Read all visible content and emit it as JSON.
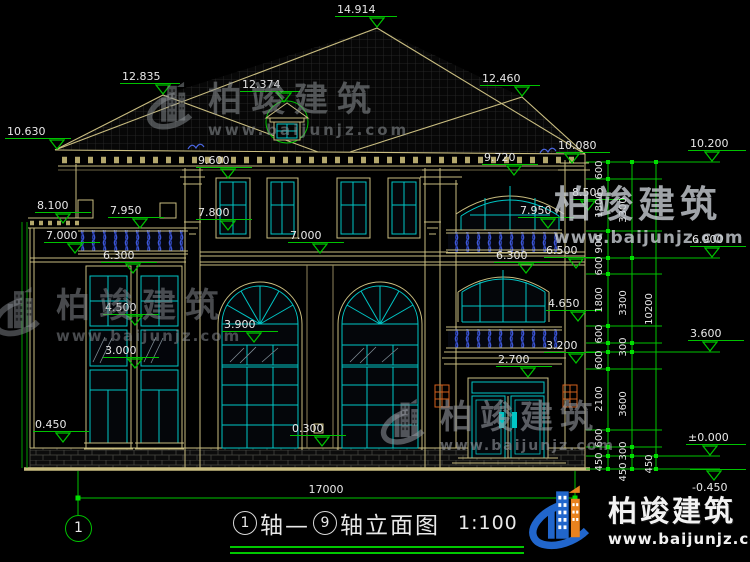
{
  "brand": {
    "name": "柏竣建筑",
    "url": "www.baijunjz.com"
  },
  "title": {
    "axis_start": "1",
    "mid": "轴—",
    "axis_end": "9",
    "suffix": "轴立面图",
    "scale": "1:100"
  },
  "axis_bubble_label": "1",
  "total_width_dim": "17000",
  "elevation_markers": [
    {
      "label": "14.914",
      "tip": [
        377,
        28
      ],
      "lx": 335,
      "lw": 62
    },
    {
      "label": "12.835",
      "tip": [
        163,
        95
      ],
      "lx": 120,
      "lw": 60
    },
    {
      "label": "12.374",
      "tip": [
        284,
        103
      ],
      "lx": 240,
      "lw": 60
    },
    {
      "label": "12.460",
      "tip": [
        522,
        97
      ],
      "lx": 480,
      "lw": 60
    },
    {
      "label": "10.630",
      "tip": [
        57,
        150
      ],
      "lx": 5,
      "lw": 66
    },
    {
      "label": "10.080",
      "tip": [
        572,
        164
      ],
      "lx": 556,
      "lw": 54
    },
    {
      "label": "9.600",
      "tip": [
        228,
        179
      ],
      "lx": 196,
      "lw": 56
    },
    {
      "label": "9.720",
      "tip": [
        514,
        176
      ],
      "lx": 482,
      "lw": 56
    },
    {
      "label": "8.100",
      "tip": [
        63,
        224
      ],
      "lx": 35,
      "lw": 56
    },
    {
      "label": "7.950",
      "tip": [
        140,
        229
      ],
      "lx": 108,
      "lw": 56
    },
    {
      "label": "7.800",
      "tip": [
        228,
        231
      ],
      "lx": 196,
      "lw": 56
    },
    {
      "label": "8.500",
      "tip": [
        588,
        211
      ],
      "lx": 570,
      "lw": 54
    },
    {
      "label": "7.950",
      "tip": [
        548,
        229
      ],
      "lx": 518,
      "lw": 56
    },
    {
      "label": "7.000",
      "tip": [
        75,
        254
      ],
      "lx": 44,
      "lw": 56
    },
    {
      "label": "7.000",
      "tip": [
        320,
        254
      ],
      "lx": 288,
      "lw": 56
    },
    {
      "label": "6.300",
      "tip": [
        133,
        274
      ],
      "lx": 101,
      "lw": 56
    },
    {
      "label": "6.300",
      "tip": [
        526,
        274
      ],
      "lx": 494,
      "lw": 56
    },
    {
      "label": "6.500",
      "tip": [
        576,
        269
      ],
      "lx": 544,
      "lw": 56
    },
    {
      "label": "6.900",
      "tip": [
        712,
        258
      ],
      "lx": 690,
      "lw": 56
    },
    {
      "label": "4.500",
      "tip": [
        135,
        326
      ],
      "lx": 103,
      "lw": 56
    },
    {
      "label": "4.650",
      "tip": [
        578,
        322
      ],
      "lx": 546,
      "lw": 56
    },
    {
      "label": "3.900",
      "tip": [
        254,
        343
      ],
      "lx": 222,
      "lw": 56
    },
    {
      "label": "3.600",
      "tip": [
        710,
        352
      ],
      "lx": 688,
      "lw": 56
    },
    {
      "label": "3.200",
      "tip": [
        576,
        364
      ],
      "lx": 544,
      "lw": 56
    },
    {
      "label": "3.000",
      "tip": [
        135,
        369
      ],
      "lx": 103,
      "lw": 56
    },
    {
      "label": "2.700",
      "tip": [
        528,
        378
      ],
      "lx": 496,
      "lw": 56
    },
    {
      "label": "0.450",
      "tip": [
        63,
        443
      ],
      "lx": 33,
      "lw": 56
    },
    {
      "label": "0.300",
      "tip": [
        322,
        447
      ],
      "lx": 290,
      "lw": 56
    },
    {
      "label": "10.200",
      "tip": [
        712,
        162
      ],
      "lx": 688,
      "lw": 58
    },
    {
      "label": "±0.000",
      "tip": [
        710,
        456
      ],
      "lx": 686,
      "lw": 60
    },
    {
      "label": "-0.450",
      "tip": [
        714,
        469
      ],
      "lx": 690,
      "lw": 56,
      "below": true
    }
  ],
  "chain_dims": [
    {
      "v": "600",
      "x": 600,
      "y": 170
    },
    {
      "v": "1800",
      "x": 600,
      "y": 205
    },
    {
      "v": "900",
      "x": 600,
      "y": 244
    },
    {
      "v": "600",
      "x": 600,
      "y": 266
    },
    {
      "v": "1800",
      "x": 600,
      "y": 300
    },
    {
      "v": "600",
      "x": 600,
      "y": 334
    },
    {
      "v": "600",
      "x": 600,
      "y": 360
    },
    {
      "v": "2100",
      "x": 600,
      "y": 399
    },
    {
      "v": "600",
      "x": 600,
      "y": 438
    },
    {
      "v": "450",
      "x": 600,
      "y": 462
    },
    {
      "v": "3300",
      "x": 624,
      "y": 210
    },
    {
      "v": "3300",
      "x": 624,
      "y": 303
    },
    {
      "v": "300",
      "x": 624,
      "y": 347
    },
    {
      "v": "3600",
      "x": 624,
      "y": 404
    },
    {
      "v": "300",
      "x": 624,
      "y": 451
    },
    {
      "v": "450",
      "x": 624,
      "y": 472
    },
    {
      "v": "10200",
      "x": 650,
      "y": 309
    },
    {
      "v": "450",
      "x": 650,
      "y": 464
    }
  ]
}
